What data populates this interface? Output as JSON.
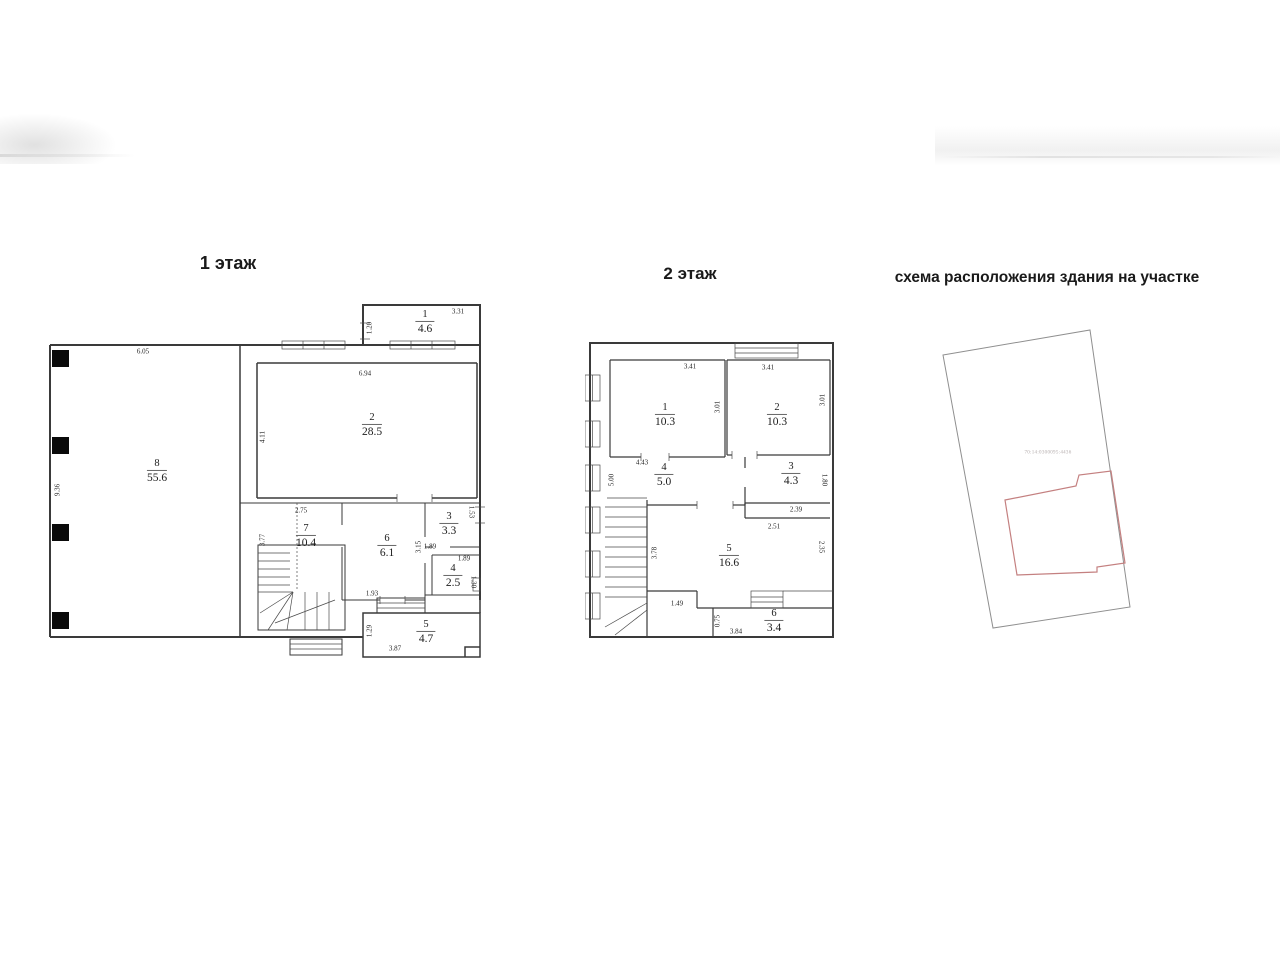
{
  "page": {
    "background": "#ffffff"
  },
  "floor1": {
    "title": "1 этаж",
    "rooms": [
      {
        "number": "1",
        "area": "4.6"
      },
      {
        "number": "2",
        "area": "28.5"
      },
      {
        "number": "3",
        "area": "3.3"
      },
      {
        "number": "4",
        "area": "2.5"
      },
      {
        "number": "5",
        "area": "4.7"
      },
      {
        "number": "6",
        "area": "6.1"
      },
      {
        "number": "7",
        "area": "10.4"
      },
      {
        "number": "8",
        "area": "55.6"
      }
    ],
    "dims": [
      "6.05",
      "9.36",
      "3.31",
      "1.20",
      "6.94",
      "4.11",
      "2.75",
      "3.77",
      "3.15",
      "1.93",
      "1.53",
      "1.89",
      "1.89",
      "1.30",
      "1.29",
      "3.87"
    ]
  },
  "floor2": {
    "title": "2 этаж",
    "rooms": [
      {
        "number": "1",
        "area": "10.3"
      },
      {
        "number": "2",
        "area": "10.3"
      },
      {
        "number": "3",
        "area": "4.3"
      },
      {
        "number": "4",
        "area": "5.0"
      },
      {
        "number": "5",
        "area": "16.6"
      },
      {
        "number": "6",
        "area": "3.4"
      }
    ],
    "dims": [
      "3.41",
      "3.01",
      "3.41",
      "3.01",
      "4.43",
      "5.00",
      "1.80",
      "2.39",
      "2.51",
      "3.78",
      "2.35",
      "1.49",
      "0.75",
      "3.84"
    ]
  },
  "site": {
    "title": "схема расположения здания на участке",
    "cadastral": "70:14:0300095:4436",
    "plot_color": "#8f8f8f",
    "building_color": "#c48080"
  }
}
